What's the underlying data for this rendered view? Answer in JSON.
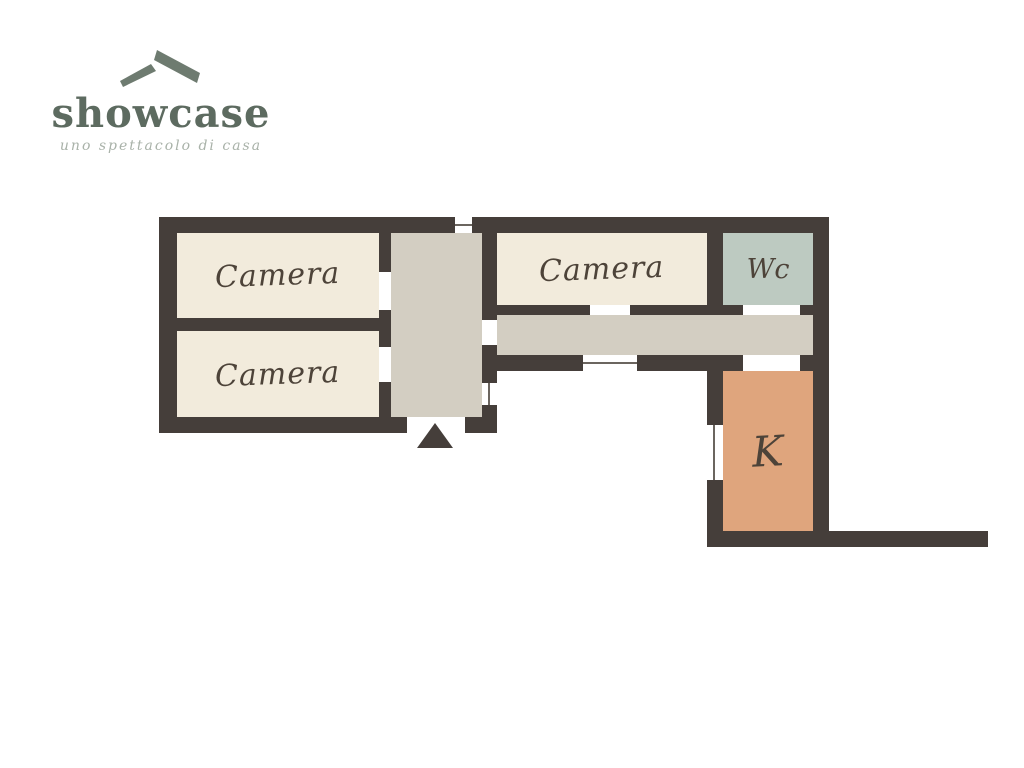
{
  "logo": {
    "brand": "showcase",
    "tagline": "uno spettacolo di casa",
    "colors": {
      "brand": "#5d6b60",
      "icon": "#6e7b70",
      "tagline": "#a9b2a9"
    }
  },
  "floorplan": {
    "colors": {
      "wall": "#453e3a",
      "label": "#4d4339",
      "window_line": "#6b655f",
      "circulation_fill": "#d3cec2"
    },
    "rooms": {
      "camera_top_left": {
        "label": "Camera",
        "fill": "#f2ebdc"
      },
      "camera_bottom_left": {
        "label": "Camera",
        "fill": "#f2ebdc"
      },
      "camera_right": {
        "label": "Camera",
        "fill": "#f2ebdc"
      },
      "wc": {
        "label": "Wc",
        "fill": "#bdcac1"
      },
      "kitchen": {
        "label": "K",
        "fill": "#dfa57d"
      },
      "hallway": {
        "label": "",
        "fill": "#d3cec2"
      },
      "corridor": {
        "label": "",
        "fill": "#d3cec2"
      }
    },
    "entrance_marker": "up-triangle"
  }
}
